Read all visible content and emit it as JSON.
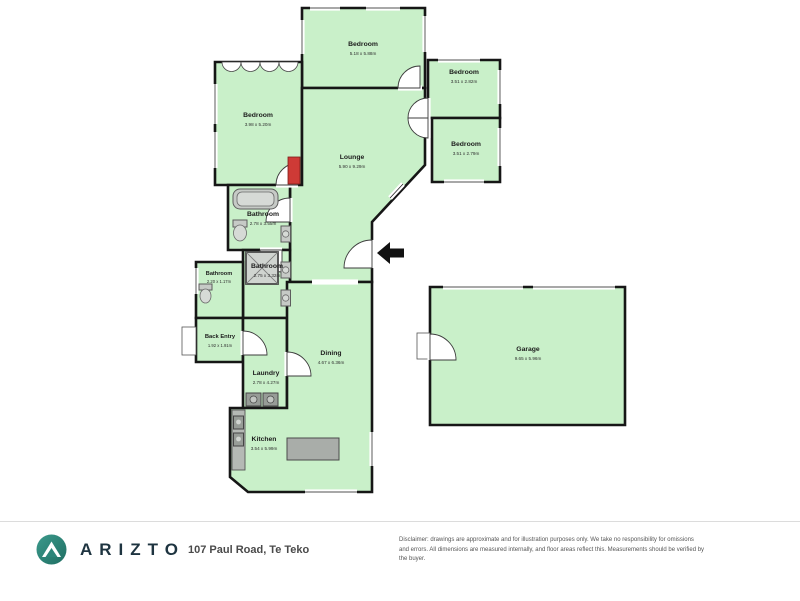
{
  "rooms": [
    {
      "name": "Bedroom",
      "dims": "5.18 x 5.88m"
    },
    {
      "name": "Bedroom",
      "dims": "3.51 x 2.82m"
    },
    {
      "name": "Bedroom",
      "dims": "3.51 x 2.79m"
    },
    {
      "name": "Bedroom",
      "dims": "3.98 x 5.20m"
    },
    {
      "name": "Lounge",
      "dims": "5.90 x 9.29m"
    },
    {
      "name": "Bathroom",
      "dims": "2.78 x 3.55m"
    },
    {
      "name": "Bathroom",
      "dims": "2.75 x 3.32m"
    },
    {
      "name": "Bathroom",
      "dims": "2.20 x 1.17m"
    },
    {
      "name": "Back Entry",
      "dims": "1.92 x 1.91m"
    },
    {
      "name": "Laundry",
      "dims": "2.78 x 4.27m"
    },
    {
      "name": "Dining",
      "dims": "4.67 x 6.36m"
    },
    {
      "name": "Kitchen",
      "dims": "3.54 x 5.99m"
    },
    {
      "name": "Garage",
      "dims": "9.65 x 5.96m"
    }
  ],
  "footer": {
    "brand": "ARIZTO",
    "address": "107 Paul Road, Te Teko",
    "disclaimer_line1": "Disclaimer: drawings are approximate and for illustration purposes only. We take no responsibility for omissions and errors.",
    "disclaimer_line2": "All dimensions are measured internally, and floor areas reflect this. Measurements should be verified by the buyer."
  },
  "colors": {
    "room_fill": "#c9f0c9",
    "wall": "#161616",
    "fireplace_red": "#ce3a36",
    "logo_teal": "#2c8579",
    "brand_navy": "#1e3440"
  }
}
